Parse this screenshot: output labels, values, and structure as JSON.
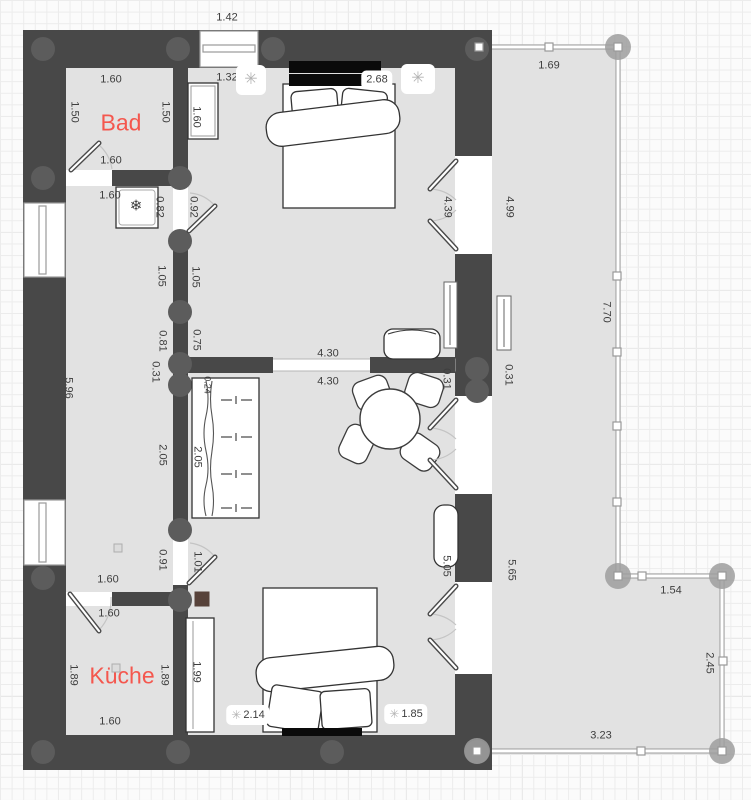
{
  "app": {
    "description": "Floor plan editor canvas with two-room apartment and terrace"
  },
  "colors": {
    "background": "#fbfbfb",
    "grid_line": "#ececec",
    "wall": "#484848",
    "column": "#5c5c5c",
    "floor": "#e2e2e2",
    "terrace_floor": "#e2e2e2",
    "room_label_accent": "#f4574e",
    "dimension_text": "#3e3e3e",
    "handle_fill": "#ffffff",
    "handle_stroke": "#999999",
    "vertex_fill": "#9d9d9d",
    "stove": "#57423a",
    "headboard": "#0a0a0a"
  },
  "rooms": [
    {
      "label": "Bad",
      "x": 121,
      "y": 123
    },
    {
      "label": "Küche",
      "x": 122,
      "y": 676
    }
  ],
  "dimensions": [
    {
      "text": "1.42",
      "x": 227,
      "y": 18
    },
    {
      "text": "1.60",
      "x": 111,
      "y": 80
    },
    {
      "text": "1.50",
      "x": 74,
      "y": 112,
      "rot": true
    },
    {
      "text": "1.50",
      "x": 165,
      "y": 112,
      "rot": true
    },
    {
      "text": "1.60",
      "x": 196,
      "y": 117,
      "rot": true
    },
    {
      "text": "1.32",
      "x": 227,
      "y": 78
    },
    {
      "text": "2.68",
      "x": 377,
      "y": 80,
      "pill": true
    },
    {
      "text": "1.60",
      "x": 111,
      "y": 161
    },
    {
      "text": "1.60",
      "x": 110,
      "y": 196
    },
    {
      "text": "0.82",
      "x": 159,
      "y": 207,
      "rot": true
    },
    {
      "text": "0.92",
      "x": 193,
      "y": 207,
      "rot": true
    },
    {
      "text": "1.69",
      "x": 549,
      "y": 66
    },
    {
      "text": "4.39",
      "x": 447,
      "y": 207,
      "rot": true
    },
    {
      "text": "4.99",
      "x": 509,
      "y": 207,
      "rot": true
    },
    {
      "text": "1.05",
      "x": 161,
      "y": 276,
      "rot": true
    },
    {
      "text": "1.05",
      "x": 195,
      "y": 277,
      "rot": true
    },
    {
      "text": "0.81",
      "x": 162,
      "y": 341,
      "rot": true
    },
    {
      "text": "0.75",
      "x": 196,
      "y": 340,
      "rot": true
    },
    {
      "text": "0.31",
      "x": 155,
      "y": 372,
      "rot": true
    },
    {
      "text": "5.96",
      "x": 68,
      "y": 388,
      "rot": true
    },
    {
      "text": "4.30",
      "x": 328,
      "y": 354
    },
    {
      "text": "4.30",
      "x": 328,
      "y": 382
    },
    {
      "text": "0.31",
      "x": 446,
      "y": 379,
      "rot": true
    },
    {
      "text": "0.31",
      "x": 508,
      "y": 375,
      "rot": true
    },
    {
      "text": "0.24",
      "x": 207,
      "y": 385,
      "rot": true,
      "small": true
    },
    {
      "text": "2.05",
      "x": 162,
      "y": 455,
      "rot": true
    },
    {
      "text": "2.05",
      "x": 197,
      "y": 457,
      "rot": true
    },
    {
      "text": "0.91",
      "x": 162,
      "y": 560,
      "rot": true
    },
    {
      "text": "1.01",
      "x": 197,
      "y": 562,
      "rot": true
    },
    {
      "text": "1.60",
      "x": 108,
      "y": 580
    },
    {
      "text": "1.60",
      "x": 109,
      "y": 614
    },
    {
      "text": "1.89",
      "x": 73,
      "y": 675,
      "rot": true
    },
    {
      "text": "1.89",
      "x": 164,
      "y": 675,
      "rot": true
    },
    {
      "text": "1.99",
      "x": 196,
      "y": 672,
      "rot": true
    },
    {
      "text": "1.60",
      "x": 110,
      "y": 722
    },
    {
      "text": "2.14",
      "x": 248,
      "y": 715,
      "pill": true,
      "icon": "ceiling-lamp"
    },
    {
      "text": "1.85",
      "x": 406,
      "y": 714,
      "pill": true,
      "icon": "ceiling-lamp"
    },
    {
      "text": "5.05",
      "x": 446,
      "y": 566,
      "rot": true
    },
    {
      "text": "5.65",
      "x": 511,
      "y": 570,
      "rot": true
    },
    {
      "text": "7.70",
      "x": 606,
      "y": 312,
      "rot": true
    },
    {
      "text": "1.54",
      "x": 671,
      "y": 591
    },
    {
      "text": "2.45",
      "x": 709,
      "y": 663,
      "rot": true
    },
    {
      "text": "3.23",
      "x": 601,
      "y": 736
    }
  ],
  "icons": [
    {
      "name": "ceiling-lamp",
      "glyph": "✳",
      "x": 251,
      "y": 80,
      "pill": true,
      "w": 30,
      "h": 30
    },
    {
      "name": "ceiling-lamp",
      "glyph": "✳",
      "x": 418,
      "y": 79,
      "pill": true,
      "w": 34,
      "h": 30
    },
    {
      "name": "snowflake",
      "glyph": "❄",
      "x": 136,
      "y": 206
    },
    {
      "name": "stove",
      "x": 202,
      "y": 599
    },
    {
      "name": "square-marker",
      "x": 118,
      "y": 548
    },
    {
      "name": "square-marker",
      "x": 116,
      "y": 668
    }
  ]
}
